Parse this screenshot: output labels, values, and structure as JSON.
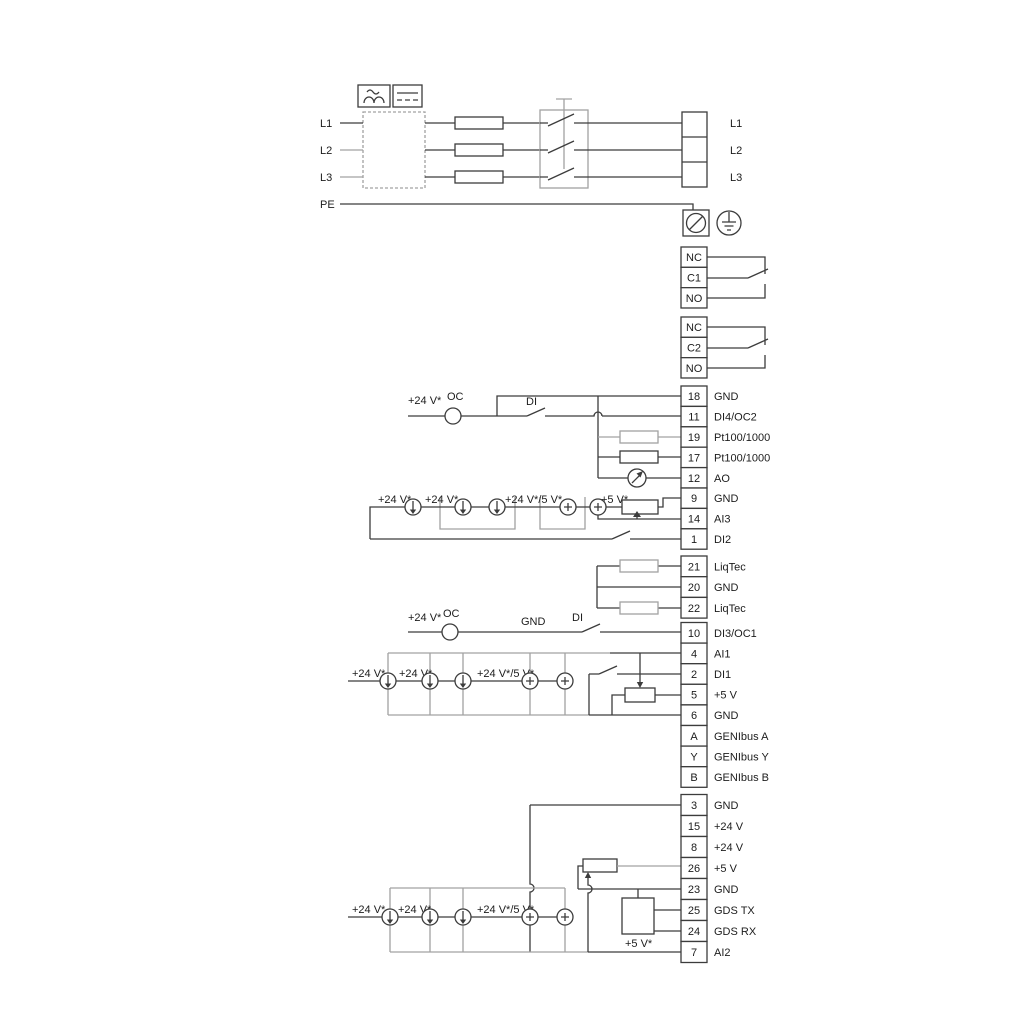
{
  "colors": {
    "ink": "#3c3c3c",
    "grey": "#a2a2a2",
    "background": "#ffffff"
  },
  "power": {
    "phase_in": [
      "L1",
      "L2",
      "L3"
    ],
    "pe": "PE",
    "phase_out": [
      "L1",
      "L2",
      "L3"
    ]
  },
  "terminals": {
    "relay1": [
      {
        "no": "NC"
      },
      {
        "no": "C1"
      },
      {
        "no": "NO"
      }
    ],
    "relay2": [
      {
        "no": "NC"
      },
      {
        "no": "C2"
      },
      {
        "no": "NO"
      }
    ],
    "io_group1": [
      {
        "no": "18",
        "label": "GND"
      },
      {
        "no": "11",
        "label": "DI4/OC2"
      },
      {
        "no": "19",
        "label": "Pt100/1000"
      },
      {
        "no": "17",
        "label": "Pt100/1000"
      },
      {
        "no": "12",
        "label": "AO"
      },
      {
        "no": "9",
        "label": "GND"
      },
      {
        "no": "14",
        "label": "AI3"
      },
      {
        "no": "1",
        "label": "DI2"
      }
    ],
    "liqtec_group": [
      {
        "no": "21",
        "label": "LiqTec"
      },
      {
        "no": "20",
        "label": "GND"
      },
      {
        "no": "22",
        "label": "LiqTec"
      }
    ],
    "io_group2": [
      {
        "no": "10",
        "label": "DI3/OC1"
      },
      {
        "no": "4",
        "label": "AI1"
      },
      {
        "no": "2",
        "label": "DI1"
      },
      {
        "no": "5",
        "label": "+5 V"
      },
      {
        "no": "6",
        "label": "GND"
      },
      {
        "no": "A",
        "label": "GENIbus A"
      },
      {
        "no": "Y",
        "label": "GENIbus Y"
      },
      {
        "no": "B",
        "label": "GENIbus B"
      }
    ],
    "io_group3": [
      {
        "no": "3",
        "label": "GND"
      },
      {
        "no": "15",
        "label": "+24 V"
      },
      {
        "no": "8",
        "label": "+24 V"
      },
      {
        "no": "26",
        "label": "+5 V"
      },
      {
        "no": "23",
        "label": "GND"
      },
      {
        "no": "25",
        "label": "GDS TX"
      },
      {
        "no": "24",
        "label": "GDS RX"
      },
      {
        "no": "7",
        "label": "AI2"
      }
    ]
  },
  "ann": {
    "v24": "+24 V*",
    "v24_5": "+24 V*/5 V*",
    "v5": "+5 V*",
    "oc": "OC",
    "di": "DI",
    "gnd": "GND"
  }
}
